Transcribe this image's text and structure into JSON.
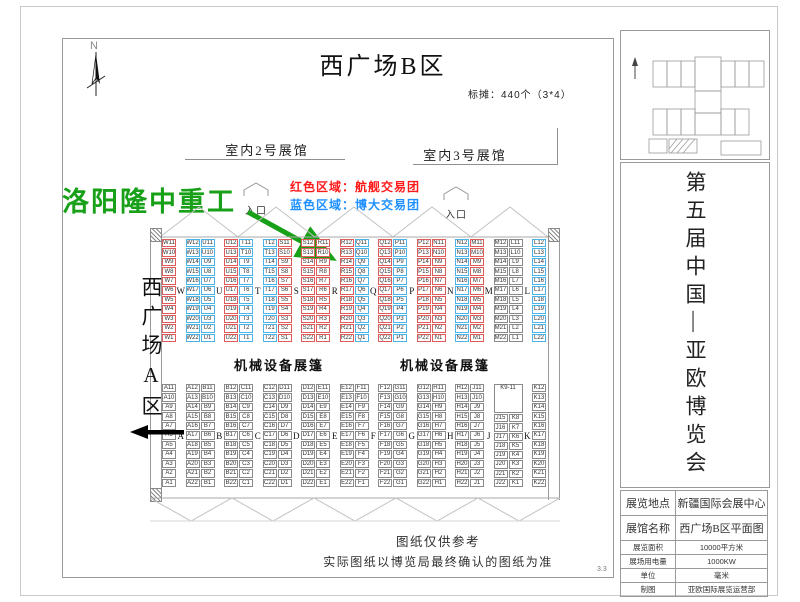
{
  "page": {
    "north_label": "N",
    "title": "西广场B区",
    "booth_note": "标摊：440个（3*4）",
    "hall2_label": "室内2号展馆",
    "hall3_label": "室内3号展馆",
    "entrance_label": "入口",
    "legend": {
      "red_text": "红色区域：航舰交易团",
      "blue_text": "蓝色区域：博大交易团"
    },
    "company_annotation": "洛阳隆中重工",
    "west_area_label": "西广场A区",
    "tent_label_left": "机械设备展篷",
    "tent_label_right": "机械设备展篷",
    "footer_line1": "图纸仅供参考",
    "footer_line2": "实际图纸以博览局最终确认的图纸为准",
    "page_number": "3.3"
  },
  "colors": {
    "booth_red": "#e05a5a",
    "booth_blue": "#4ab4e6",
    "booth_plain": "#8a8a8a",
    "legend_red": "#ff1a1a",
    "legend_blue": "#1e90ff",
    "annotation_green": "#18a018"
  },
  "sidebar": {
    "event_title": "第五届中国—亚欧博览会",
    "info_table": [
      {
        "label": "展览地点",
        "value": "新疆国际会展中心"
      },
      {
        "label": "展馆名称",
        "value": "西广场B区平面图"
      },
      {
        "label": "展览面积",
        "value": "10000平方米"
      },
      {
        "label": "展场用电量",
        "value": "1000KW"
      },
      {
        "label": "单位",
        "value": "毫米"
      },
      {
        "label": "制图",
        "value": "亚欧国际展览运营部"
      }
    ]
  },
  "grid": {
    "upper": {
      "rows": 11,
      "groups": [
        {
          "letter": "W",
          "subcols": [
            {
              "color": "red",
              "prefix": "W",
              "from": 11,
              "to": 1
            }
          ]
        },
        {
          "letter": "U",
          "subcols": [
            {
              "color": "blue",
              "prefix": "W",
              "from": 12,
              "to": 22
            },
            {
              "color": "blue",
              "prefix": "U",
              "from": 11,
              "to": 1
            }
          ]
        },
        {
          "letter": "T",
          "subcols": [
            {
              "color": "red",
              "prefix": "U",
              "from": 12,
              "to": 22
            },
            {
              "color": "blue",
              "prefix": "T",
              "from": 11,
              "to": 1
            }
          ]
        },
        {
          "letter": "S",
          "subcols": [
            {
              "color": "blue",
              "prefix": "T",
              "from": 12,
              "to": 22
            },
            {
              "color": "red",
              "prefix": "S",
              "from": 11,
              "to": 1
            }
          ]
        },
        {
          "letter": "R",
          "subcols": [
            {
              "color": "red",
              "prefix": "S",
              "from": 12,
              "to": 22
            },
            {
              "color": "red",
              "prefix": "R",
              "from": 11,
              "to": 1
            }
          ]
        },
        {
          "letter": "Q",
          "subcols": [
            {
              "color": "red",
              "prefix": "R",
              "from": 12,
              "to": 22
            },
            {
              "color": "blue",
              "prefix": "Q",
              "from": 11,
              "to": 1
            }
          ]
        },
        {
          "letter": "P",
          "subcols": [
            {
              "color": "red",
              "prefix": "Q",
              "from": 12,
              "to": 22
            },
            {
              "color": "blue",
              "prefix": "P",
              "from": 11,
              "to": 1
            }
          ]
        },
        {
          "letter": "N",
          "subcols": [
            {
              "color": "red",
              "prefix": "P",
              "from": 12,
              "to": 22
            },
            {
              "color": "red",
              "prefix": "N",
              "from": 11,
              "to": 1
            }
          ]
        },
        {
          "letter": "M",
          "subcols": [
            {
              "color": "blue",
              "prefix": "N",
              "from": 12,
              "to": 22
            },
            {
              "color": "red",
              "prefix": "M",
              "from": 11,
              "to": 1
            }
          ]
        },
        {
          "letter": "L",
          "subcols": [
            {
              "color": "black",
              "prefix": "M",
              "from": 12,
              "to": 22
            },
            {
              "color": "black",
              "prefix": "L",
              "from": 11,
              "to": 1
            }
          ]
        },
        {
          "subcols": [
            {
              "color": "blue",
              "prefix": "L",
              "from": 12,
              "to": 22
            }
          ]
        }
      ]
    },
    "lower": {
      "rows": 11,
      "groups": [
        {
          "letter": "A",
          "subcols": [
            {
              "color": "black",
              "prefix": "A",
              "from": 11,
              "to": 1
            }
          ]
        },
        {
          "letter": "B",
          "subcols": [
            {
              "color": "black",
              "prefix": "A",
              "from": 12,
              "to": 22
            },
            {
              "color": "black",
              "prefix": "B",
              "from": 11,
              "to": 1
            }
          ]
        },
        {
          "letter": "C",
          "subcols": [
            {
              "color": "black",
              "prefix": "B",
              "from": 12,
              "to": 22
            },
            {
              "color": "black",
              "prefix": "C",
              "from": 11,
              "to": 1
            }
          ]
        },
        {
          "letter": "D",
          "subcols": [
            {
              "color": "black",
              "prefix": "C",
              "from": 12,
              "to": 22
            },
            {
              "color": "black",
              "prefix": "D",
              "from": 11,
              "to": 1
            }
          ]
        },
        {
          "letter": "E",
          "subcols": [
            {
              "color": "black",
              "prefix": "D",
              "from": 12,
              "to": 22
            },
            {
              "color": "black",
              "prefix": "E",
              "from": 11,
              "to": 1
            }
          ]
        },
        {
          "letter": "F",
          "subcols": [
            {
              "color": "black",
              "prefix": "E",
              "from": 12,
              "to": 22
            },
            {
              "color": "black",
              "prefix": "F",
              "from": 11,
              "to": 1
            }
          ]
        },
        {
          "letter": "G",
          "subcols": [
            {
              "color": "black",
              "prefix": "F",
              "from": 12,
              "to": 22
            },
            {
              "color": "black",
              "prefix": "G",
              "from": 11,
              "to": 1
            }
          ]
        },
        {
          "letter": "H",
          "subcols": [
            {
              "color": "black",
              "prefix": "G",
              "from": 12,
              "to": 22
            },
            {
              "color": "black",
              "prefix": "H",
              "from": 11,
              "to": 1
            }
          ]
        },
        {
          "letter": "J",
          "subcols": [
            {
              "color": "black",
              "prefix": "H",
              "from": 12,
              "to": 22
            },
            {
              "color": "black",
              "prefix": "J",
              "from": 11,
              "to": 1
            }
          ]
        },
        {
          "letter": "K",
          "box": {
            "label": "K9-11",
            "rows": 3
          },
          "subcols": [
            {
              "color": "black",
              "prefix": "J",
              "from": 15,
              "to": 22
            },
            {
              "color": "black",
              "prefix": "K",
              "from": 8,
              "to": 1
            }
          ]
        },
        {
          "subcols": [
            {
              "color": "black",
              "prefix": "K",
              "from": 12,
              "to": 22
            }
          ]
        }
      ]
    }
  }
}
